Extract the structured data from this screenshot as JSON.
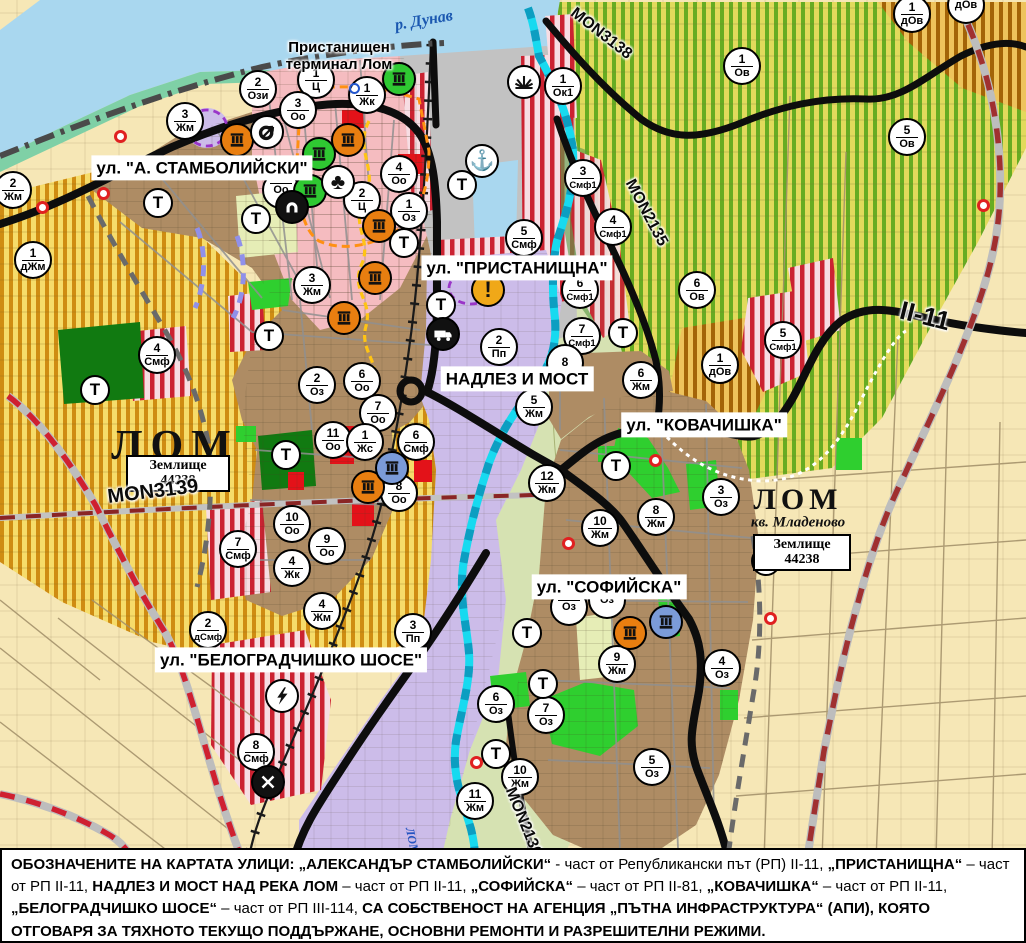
{
  "map": {
    "labels": {
      "danube": "р. Дунав",
      "terminal_line1": "Пристанищен",
      "terminal_line2": "терминал Лом",
      "lom_city": "ЛОМ",
      "lom_quarter": "ЛОМ",
      "kv_mladenovo": "кв. Младеново",
      "zemlishte_line1": "Землище",
      "zemlishte_number": "44238",
      "river_lom": "ЛОМ"
    },
    "street_labels": [
      {
        "text": "ул. \"А. СТАМБОЛИЙСКИ\"",
        "x": 202,
        "y": 168
      },
      {
        "text": "ул. \"ПРИСТАНИЩНА\"",
        "x": 517,
        "y": 268
      },
      {
        "text": "НАДЛЕЗ И МОСТ",
        "x": 517,
        "y": 379
      },
      {
        "text": "ул. \"КОВАЧИШКА\"",
        "x": 704,
        "y": 425
      },
      {
        "text": "ул. \"СОФИЙСКА\"",
        "x": 609,
        "y": 587
      },
      {
        "text": "ул. \"БЕЛОГРАДЧИШКО ШОСЕ\"",
        "x": 291,
        "y": 660
      }
    ],
    "road_labels": [
      {
        "text": "MON3138",
        "x": 601,
        "y": 34,
        "rot": 38,
        "size": 16
      },
      {
        "text": "MON2135",
        "x": 646,
        "y": 213,
        "rot": 62,
        "size": 16
      },
      {
        "text": "II-11",
        "x": 925,
        "y": 316,
        "rot": 14,
        "size": 26
      },
      {
        "text": "MON3139",
        "x": 153,
        "y": 492,
        "rot": -7,
        "size": 20
      },
      {
        "text": "MON2136",
        "x": 523,
        "y": 822,
        "rot": 68,
        "size": 16
      }
    ],
    "zone_markers": [
      {
        "n": "2",
        "c": "Ози",
        "x": 258,
        "y": 89
      },
      {
        "n": "1",
        "c": "Ц",
        "x": 316,
        "y": 80
      },
      {
        "n": "1",
        "c": "Жк",
        "x": 367,
        "y": 95
      },
      {
        "n": "3",
        "c": "Оо",
        "x": 298,
        "y": 110
      },
      {
        "n": "3",
        "c": "Жм",
        "x": 185,
        "y": 121
      },
      {
        "n": "4",
        "c": "Оо",
        "x": 399,
        "y": 174
      },
      {
        "n": "2",
        "c": "Ц",
        "x": 362,
        "y": 200
      },
      {
        "n": "1",
        "c": "Оз",
        "x": 409,
        "y": 211
      },
      {
        "n": "",
        "c": "Оо",
        "x": 281,
        "y": 190
      },
      {
        "n": "2",
        "c": "Жм",
        "x": 13,
        "y": 190
      },
      {
        "n": "1",
        "c": "дЖм",
        "x": 33,
        "y": 260
      },
      {
        "n": "3",
        "c": "Жм",
        "x": 312,
        "y": 285
      },
      {
        "n": "1",
        "c": "Ок1",
        "x": 563,
        "y": 86
      },
      {
        "n": "5",
        "c": "Смф",
        "x": 524,
        "y": 238
      },
      {
        "n": "3",
        "c": "Смф1",
        "x": 583,
        "y": 178
      },
      {
        "n": "4",
        "c": "Смф1",
        "x": 613,
        "y": 227
      },
      {
        "n": "6",
        "c": "Смф1",
        "x": 580,
        "y": 290
      },
      {
        "n": "7",
        "c": "Смф1",
        "x": 582,
        "y": 336
      },
      {
        "n": "1",
        "c": "Ов",
        "x": 742,
        "y": 66
      },
      {
        "n": "6",
        "c": "Ов",
        "x": 697,
        "y": 290
      },
      {
        "n": "5",
        "c": "Ов",
        "x": 907,
        "y": 137
      },
      {
        "n": "1",
        "c": "дОв",
        "x": 912,
        "y": 14
      },
      {
        "n": "",
        "c": "дОв",
        "x": 966,
        "y": 5
      },
      {
        "n": "5",
        "c": "Смф1",
        "x": 783,
        "y": 340
      },
      {
        "n": "1",
        "c": "дОв",
        "x": 720,
        "y": 365
      },
      {
        "n": "4",
        "c": "Смф",
        "x": 157,
        "y": 355
      },
      {
        "n": "2",
        "c": "Оз",
        "x": 317,
        "y": 385
      },
      {
        "n": "6",
        "c": "Оо",
        "x": 362,
        "y": 381
      },
      {
        "n": "7",
        "c": "Оо",
        "x": 378,
        "y": 413
      },
      {
        "n": "11",
        "c": "Оо",
        "x": 333,
        "y": 440
      },
      {
        "n": "1",
        "c": "Жс",
        "x": 365,
        "y": 442
      },
      {
        "n": "6",
        "c": "Смф",
        "x": 416,
        "y": 442
      },
      {
        "n": "8",
        "c": "Оо",
        "x": 399,
        "y": 493
      },
      {
        "n": "10",
        "c": "Оо",
        "x": 292,
        "y": 524
      },
      {
        "n": "9",
        "c": "Оо",
        "x": 327,
        "y": 546
      },
      {
        "n": "4",
        "c": "Жк",
        "x": 292,
        "y": 568
      },
      {
        "n": "7",
        "c": "Смф",
        "x": 238,
        "y": 549
      },
      {
        "n": "4",
        "c": "Жм",
        "x": 322,
        "y": 611
      },
      {
        "n": "2",
        "c": "дСмф",
        "x": 208,
        "y": 630
      },
      {
        "n": "3",
        "c": "Пп",
        "x": 413,
        "y": 632
      },
      {
        "n": "8",
        "c": "Смф",
        "x": 256,
        "y": 752
      },
      {
        "n": "2",
        "c": "Пп",
        "x": 499,
        "y": 347
      },
      {
        "n": "8",
        "c": "",
        "x": 565,
        "y": 363
      },
      {
        "n": "5",
        "c": "Жм",
        "x": 534,
        "y": 407
      },
      {
        "n": "6",
        "c": "Жм",
        "x": 641,
        "y": 380
      },
      {
        "n": "12",
        "c": "Жм",
        "x": 547,
        "y": 483
      },
      {
        "n": "10",
        "c": "Жм",
        "x": 600,
        "y": 528
      },
      {
        "n": "8",
        "c": "Жм",
        "x": 656,
        "y": 517
      },
      {
        "n": "3",
        "c": "Оз",
        "x": 721,
        "y": 497
      },
      {
        "n": "",
        "c": "Оз",
        "x": 569,
        "y": 607
      },
      {
        "n": "",
        "c": "Оз",
        "x": 607,
        "y": 600
      },
      {
        "n": "9",
        "c": "Жм",
        "x": 617,
        "y": 664
      },
      {
        "n": "4",
        "c": "Оз",
        "x": 722,
        "y": 668
      },
      {
        "n": "6",
        "c": "Оз",
        "x": 496,
        "y": 704
      },
      {
        "n": "7",
        "c": "Оз",
        "x": 546,
        "y": 715
      },
      {
        "n": "5",
        "c": "Оз",
        "x": 652,
        "y": 767
      },
      {
        "n": "10",
        "c": "Жм",
        "x": 520,
        "y": 777
      },
      {
        "n": "11",
        "c": "Жм",
        "x": 475,
        "y": 801
      }
    ],
    "t_markers": [
      [
        158,
        203
      ],
      [
        256,
        219
      ],
      [
        269,
        336
      ],
      [
        95,
        390
      ],
      [
        286,
        455
      ],
      [
        462,
        185
      ],
      [
        404,
        243
      ],
      [
        441,
        305
      ],
      [
        623,
        333
      ],
      [
        616,
        466
      ],
      [
        527,
        633
      ],
      [
        543,
        684
      ],
      [
        496,
        754
      ],
      [
        766,
        561
      ]
    ],
    "icons": [
      {
        "type": "factory-orange",
        "x": 237,
        "y": 140
      },
      {
        "type": "factory-orange",
        "x": 348,
        "y": 140
      },
      {
        "type": "factory-orange",
        "x": 379,
        "y": 226
      },
      {
        "type": "factory-orange",
        "x": 375,
        "y": 278
      },
      {
        "type": "factory-orange",
        "x": 344,
        "y": 318
      },
      {
        "type": "factory-orange",
        "x": 368,
        "y": 487
      },
      {
        "type": "factory-orange",
        "x": 630,
        "y": 633
      },
      {
        "type": "factory-green",
        "x": 399,
        "y": 79
      },
      {
        "type": "factory-green",
        "x": 319,
        "y": 154
      },
      {
        "type": "factory-green",
        "x": 310,
        "y": 191
      },
      {
        "type": "factory-blue",
        "x": 392,
        "y": 468
      },
      {
        "type": "factory-blue",
        "x": 666,
        "y": 622
      },
      {
        "type": "anchor",
        "x": 482,
        "y": 161
      },
      {
        "type": "crane",
        "x": 524,
        "y": 82
      },
      {
        "type": "junction",
        "x": 267,
        "y": 132
      },
      {
        "type": "trees",
        "x": 338,
        "y": 182
      },
      {
        "type": "tunnel",
        "x": 292,
        "y": 207
      },
      {
        "type": "truck",
        "x": 443,
        "y": 334
      },
      {
        "type": "warning",
        "x": 488,
        "y": 290
      },
      {
        "type": "lightning",
        "x": 282,
        "y": 696
      },
      {
        "type": "railcross",
        "x": 268,
        "y": 782
      },
      {
        "type": "red-dot",
        "x": 120,
        "y": 136
      },
      {
        "type": "red-dot",
        "x": 103,
        "y": 193
      },
      {
        "type": "red-dot",
        "x": 42,
        "y": 207
      },
      {
        "type": "red-dot",
        "x": 655,
        "y": 460
      },
      {
        "type": "red-dot",
        "x": 568,
        "y": 543
      },
      {
        "type": "red-dot",
        "x": 770,
        "y": 618
      },
      {
        "type": "red-dot",
        "x": 983,
        "y": 205
      },
      {
        "type": "red-dot",
        "x": 476,
        "y": 762
      },
      {
        "type": "blue-dot",
        "x": 354,
        "y": 88
      }
    ],
    "footer_segments": [
      {
        "t": "ОБОЗНАЧЕНИТЕ НА КАРТАТА УЛИЦИ: ",
        "b": 1
      },
      {
        "t": "„АЛЕКСАНДЪР СТАМБОЛИЙСКИ“",
        "b": 1
      },
      {
        "t": " - част от Републикански път (РП) II-11, ",
        "b": 0
      },
      {
        "t": "„ПРИСТАНИЩНА“",
        "b": 1
      },
      {
        "t": " – част от РП II-11, ",
        "b": 0
      },
      {
        "t": "НАДЛЕЗ И МОСТ НАД РЕКА ЛОМ",
        "b": 1
      },
      {
        "t": " – част от РП II-11, ",
        "b": 0
      },
      {
        "t": "„СОФИЙСКА“",
        "b": 1
      },
      {
        "t": " – част от РП II-81, ",
        "b": 0
      },
      {
        "t": "„КОВАЧИШКА“",
        "b": 1
      },
      {
        "t": " – част от РП II-11, ",
        "b": 0
      },
      {
        "t": "„БЕЛОГРАДЧИШКО ШОСЕ“",
        "b": 1
      },
      {
        "t": " – част от РП III-114, ",
        "b": 0
      },
      {
        "t": "СА СОБСТВЕНОСТ НА АГЕНЦИЯ „ПЪТНА ИНФРАСТРУКТУРА“ (АПИ), КОЯТО ОТГОВАРЯ ЗА ТЯХНОТО ТЕКУЩО ПОДДЪРЖАНЕ, ОСНОВНИ РЕМОНТИ И РАЗРЕШИТЕЛНИ РЕЖИМИ.",
        "b": 1
      }
    ],
    "colors": {
      "water": "#a9d7ef",
      "river_cyan": "#17daf0",
      "urban_brown": "#ae8c64",
      "residential_pink": "#f5bcc0",
      "industrial_lavender": "#ccbce9",
      "port_gray": "#c2c2c2",
      "vineyard_yellow": "#f6dc6a",
      "vineyard_stripe_orange": "#cf8c12",
      "vineyard_green_bg": "#e2da5c",
      "vineyard_green_stripe": "#67ac22",
      "smf_stripe_red": "#cb2231",
      "park_green": "#2fcf2f",
      "dark_green": "#117a11",
      "fields_cream": "#f6e7b6",
      "floodplain": "#d6e2b2",
      "road_black": "#0d0d0d",
      "road_red_dash": "#cf2030",
      "icon_orange": "#e87e10",
      "icon_green": "#2fc832",
      "icon_blue": "#7b9bd8"
    }
  }
}
